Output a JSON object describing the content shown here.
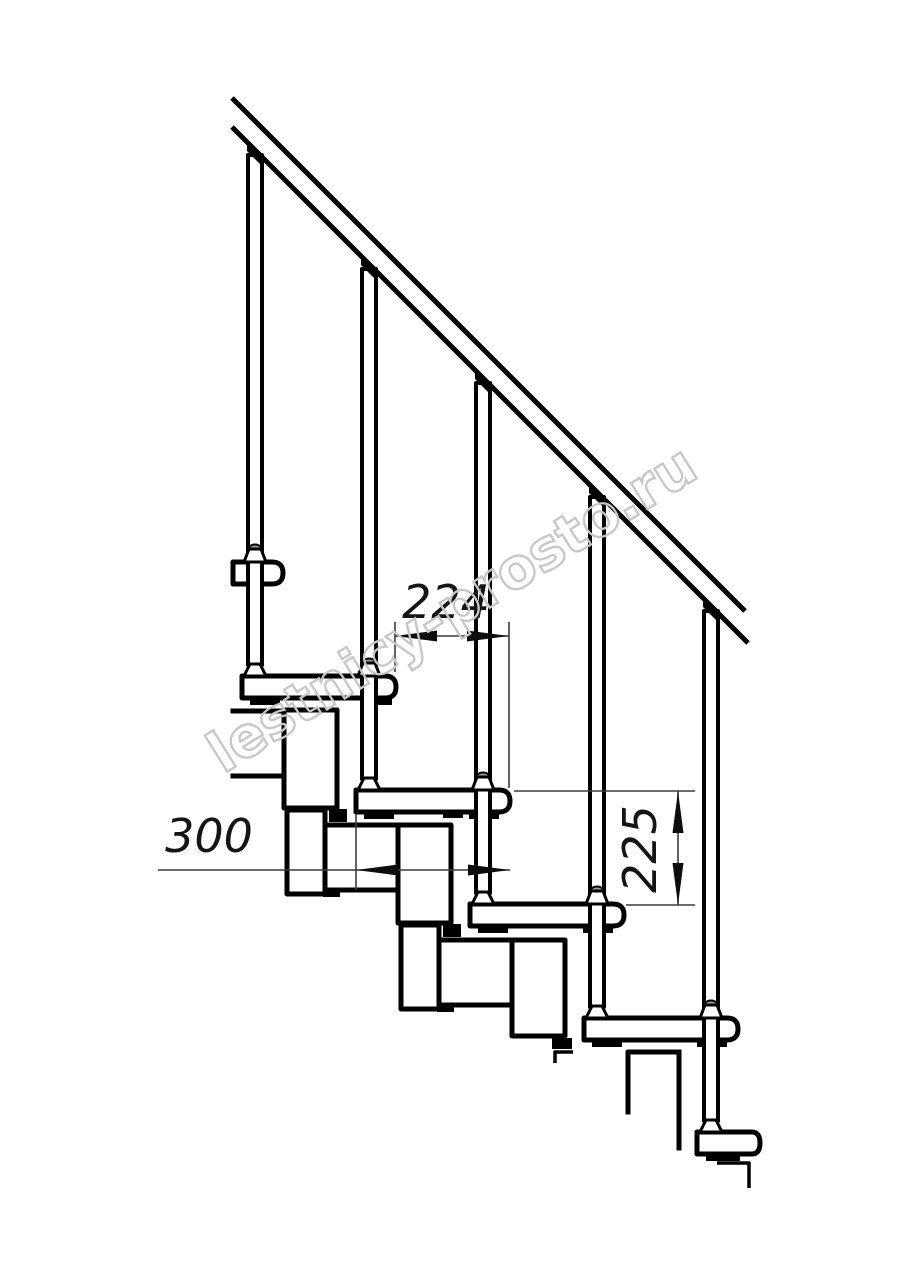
{
  "drawing": {
    "title": "Modular staircase fragment, side elevation",
    "dimensions": {
      "going": "224",
      "tread_length": "300",
      "riser": "225"
    },
    "watermark": "lestnicy-prosto.ru",
    "colors": {
      "background": "#ffffff",
      "line": "#000000",
      "dim_line": "#3c3c3c",
      "watermark": "#c7c7c7",
      "ball_fitting": "#9a9a9a"
    }
  }
}
